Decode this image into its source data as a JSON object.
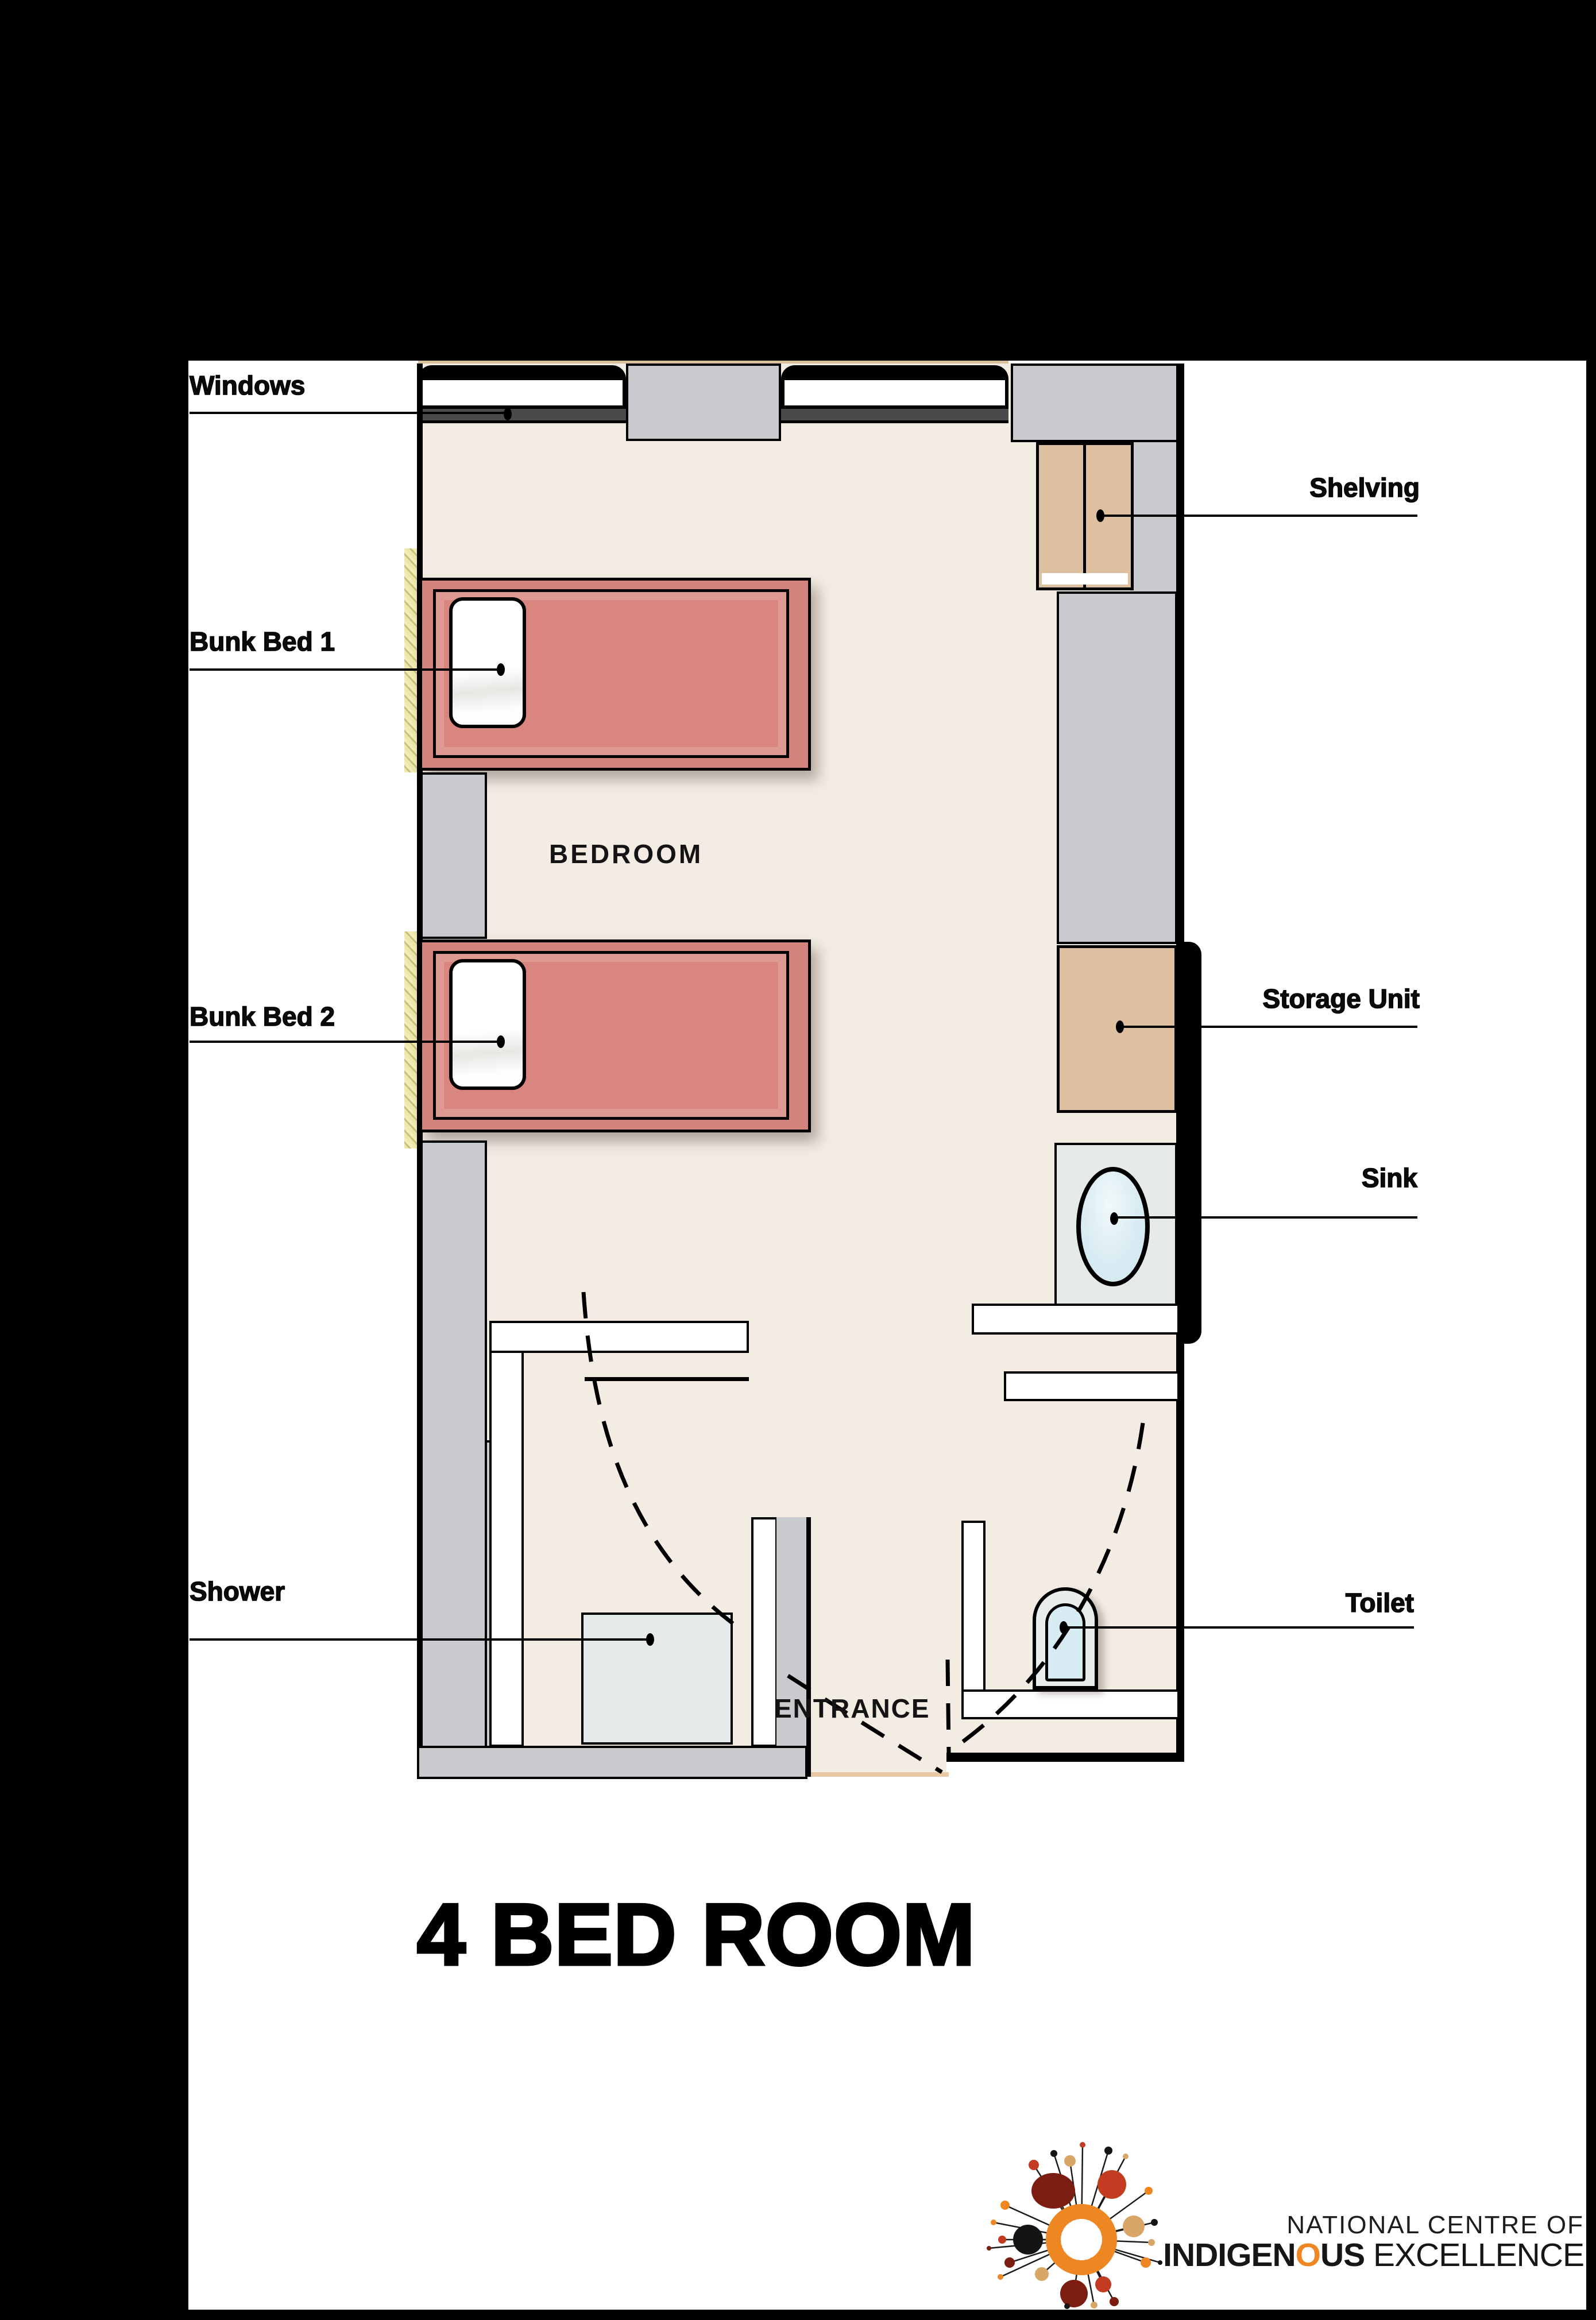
{
  "page": {
    "title": "4 BED ROOM"
  },
  "plan": {
    "room_labels": {
      "bedroom": "BEDROOM",
      "entrance": "ENTRANCE"
    },
    "callouts": {
      "windows": {
        "label": "Windows"
      },
      "bunk_bed_1": {
        "label": "Bunk Bed 1"
      },
      "bunk_bed_2": {
        "label": "Bunk Bed 2"
      },
      "shower": {
        "label": "Shower"
      },
      "shelving": {
        "label": "Shelving"
      },
      "storage_unit": {
        "label": "Storage Unit"
      },
      "sink": {
        "label": "Sink"
      },
      "toilet": {
        "label": "Toilet"
      }
    }
  },
  "footer_logo": {
    "line1": "NATIONAL CENTRE OF",
    "line2": {
      "bold_start": "INDIGEN",
      "orange_o": "O",
      "bold_end": "US",
      "light": " EXCELLENCE"
    }
  },
  "colors": {
    "page_frame": "#000000",
    "floor": "#F2ECE3",
    "wall_gray": "#C9CACD",
    "window_sill": "#4A4A4C",
    "bed_salmon": "#D5837D",
    "wood_tan": "#DCC0A0",
    "fixture_gray": "#E4E9E9",
    "water_blue": "#D7EBF2",
    "curtain_yellow": "#EDE7A9",
    "logo_orange": "#EE8722",
    "logo_maroon": "#7B1D10",
    "logo_red": "#C23B22",
    "logo_tan": "#D8A767"
  }
}
